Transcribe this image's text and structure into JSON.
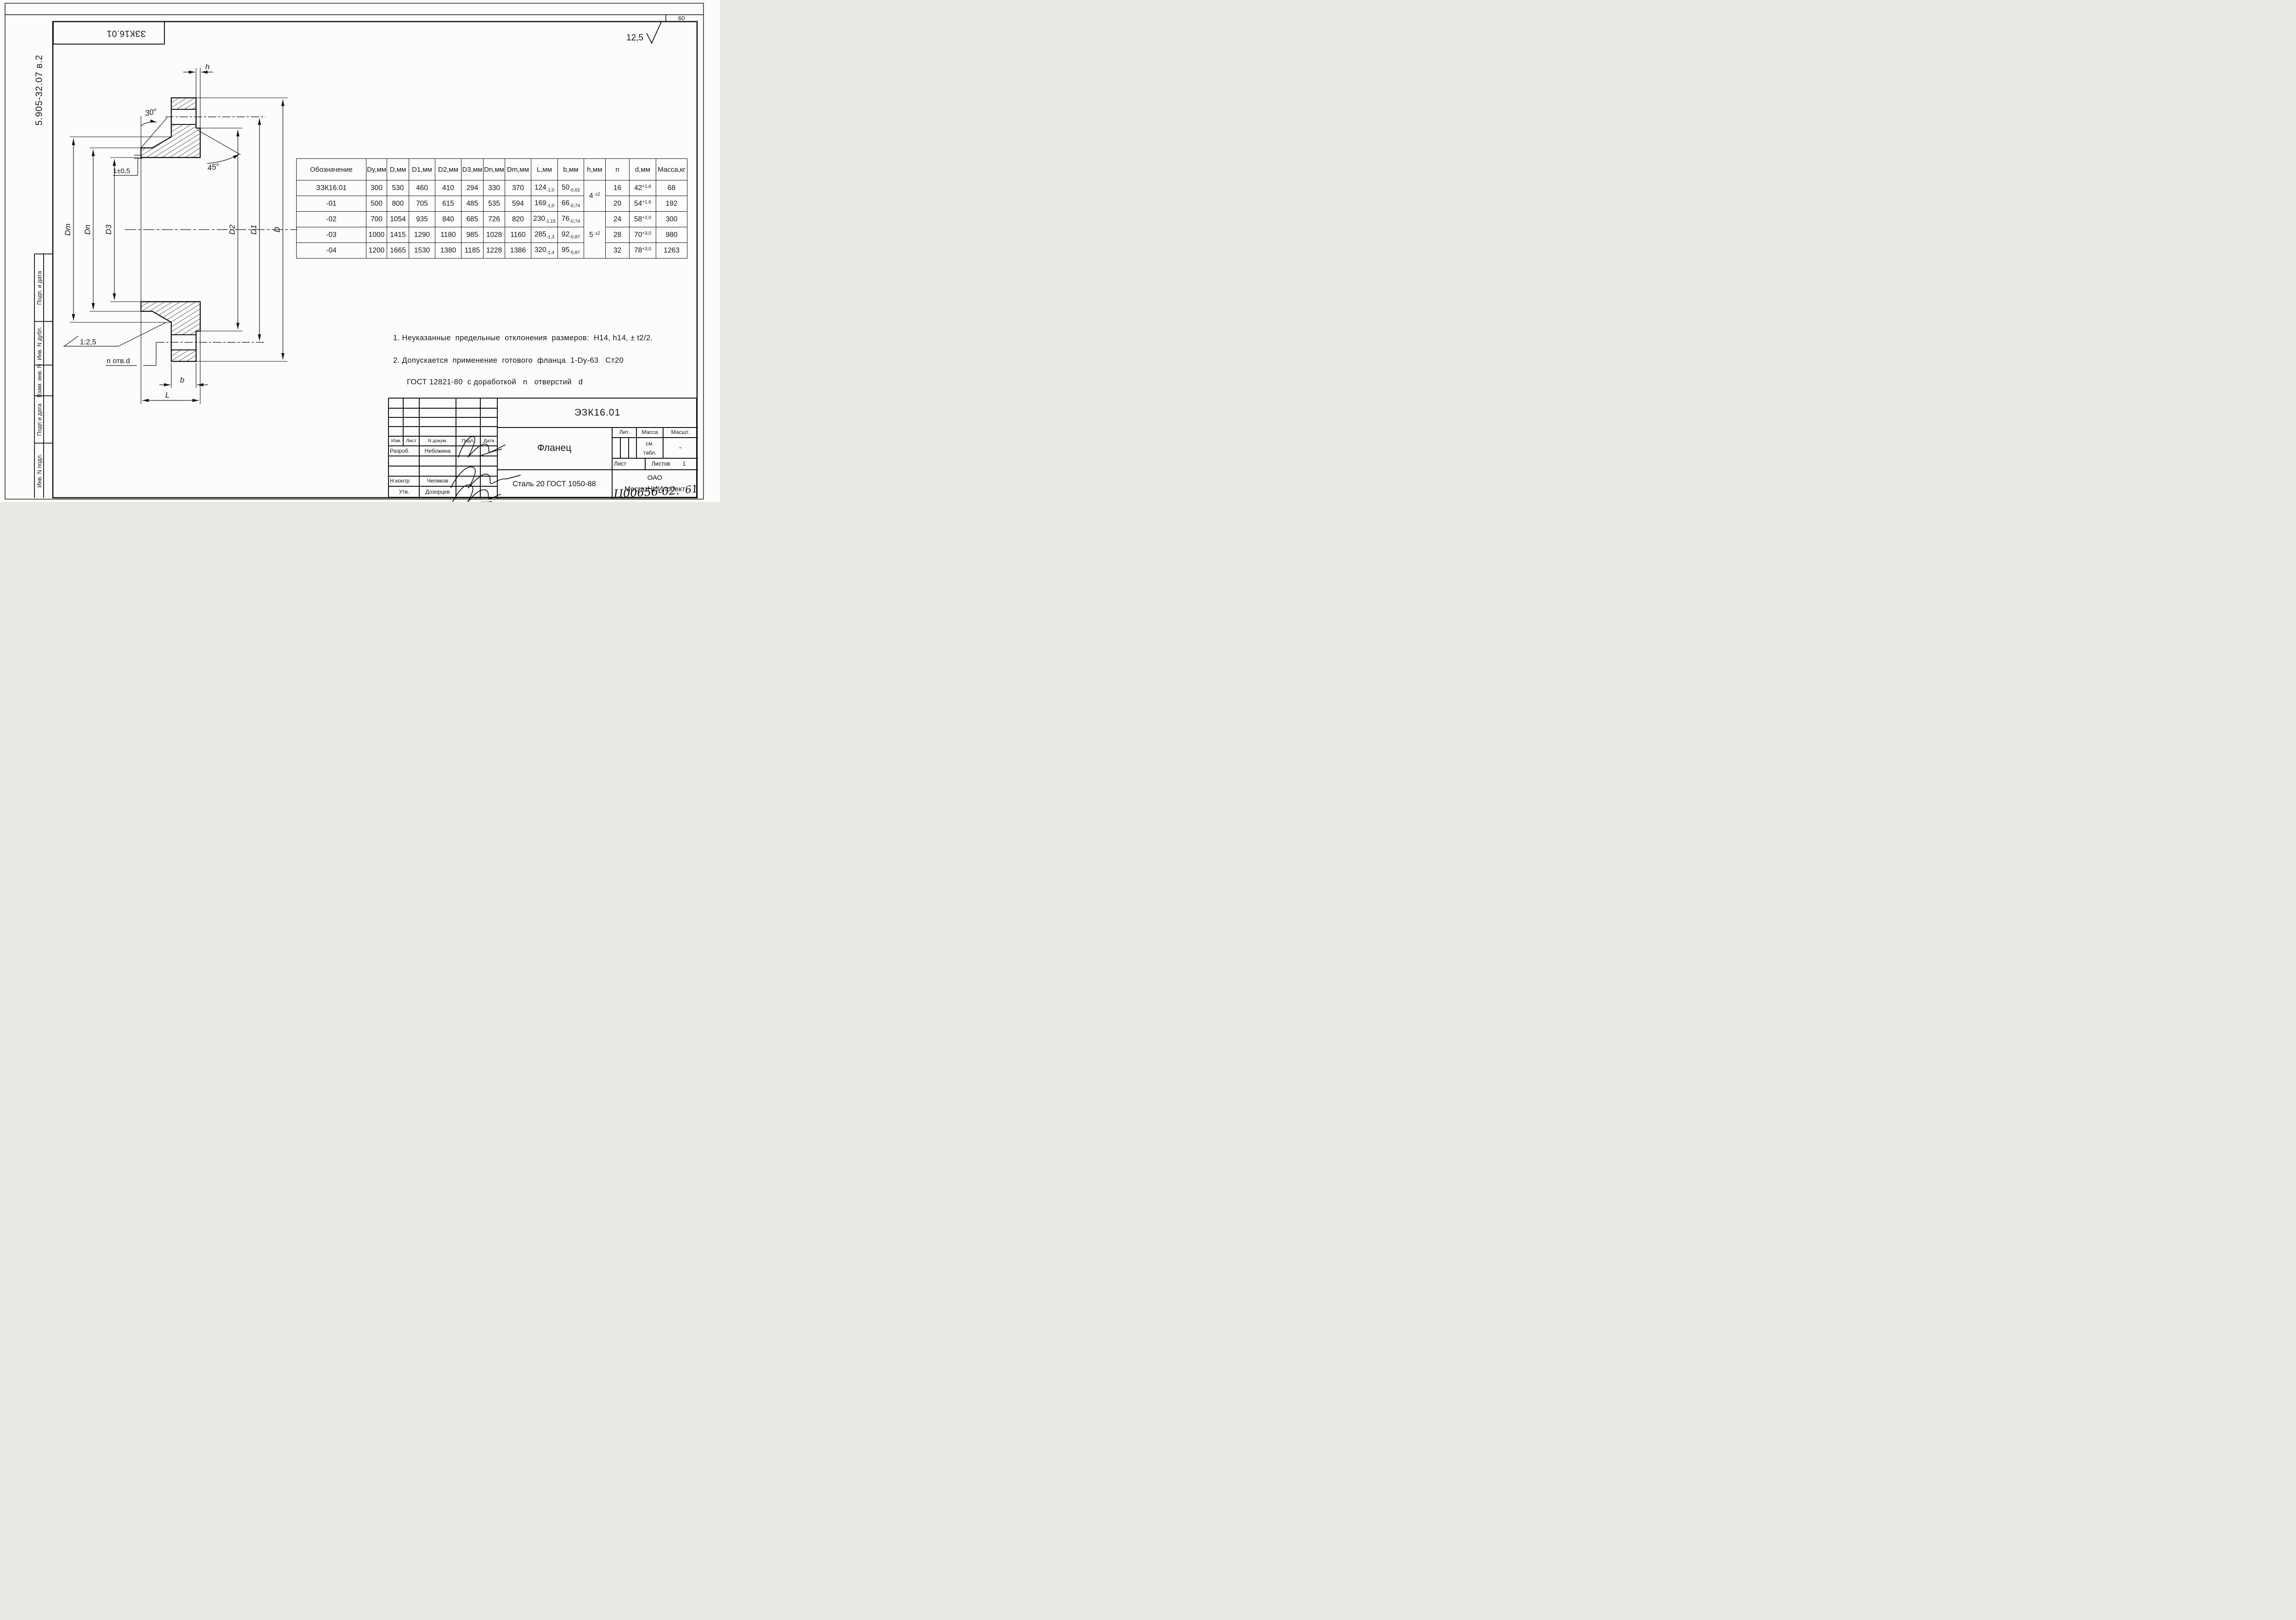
{
  "page": {
    "sheet_number": "60",
    "surface_roughness": "12,5"
  },
  "margins": {
    "doc_code_vertical": "5.905-32.07 в.2",
    "cells": [
      "Подп. и дата",
      "Инв. N дубл.",
      "Взам. инв. N",
      "Подп и дата",
      "Инв. N подл."
    ]
  },
  "top_stamp": "ЗЗК16.01",
  "drawing": {
    "labels": {
      "h": "h",
      "angle30": "30°",
      "angle45": "45°",
      "step": "1±0,5",
      "slope": "1:2,5",
      "holes": "n отв.d",
      "b": "b",
      "L": "L",
      "Dm": "Dm",
      "Dn": "Dn",
      "D3": "D3",
      "D2": "D2",
      "D1": "D1",
      "D": "D"
    }
  },
  "table": {
    "headers": [
      "Обозначение",
      "Dy,мм",
      "D,мм",
      "D1,мм",
      "D2,мм",
      "D3,мм",
      "Dn,мм",
      "Dm,мм",
      "L,мм",
      "b,мм",
      "h,мм",
      "n",
      "d,мм",
      "Масса,кг"
    ],
    "rows": [
      {
        "name": "ЗЗК16.01",
        "dy": "300",
        "d": "530",
        "d1": "460",
        "d2": "410",
        "d3": "294",
        "dn": "330",
        "dm": "370",
        "L": {
          "v": "124",
          "sub": "-1,0"
        },
        "b": {
          "v": "50",
          "sub": "-0,62"
        },
        "n": "16",
        "dhole": {
          "v": "42",
          "sup": "+1,6"
        },
        "mass": "68"
      },
      {
        "name": "-01",
        "dy": "500",
        "d": "800",
        "d1": "705",
        "d2": "615",
        "d3": "485",
        "dn": "535",
        "dm": "594",
        "L": {
          "v": "169",
          "sub": "-1,0"
        },
        "b": {
          "v": "66",
          "sub": "-0,74"
        },
        "n": "20",
        "dhole": {
          "v": "54",
          "sup": "+1,6"
        },
        "mass": "192"
      },
      {
        "name": "-02",
        "dy": "700",
        "d": "1054",
        "d1": "935",
        "d2": "840",
        "d3": "685",
        "dn": "726",
        "dm": "820",
        "L": {
          "v": "230",
          "sub": "-1,15"
        },
        "b": {
          "v": "76",
          "sub": "-0,74"
        },
        "n": "24",
        "dhole": {
          "v": "58",
          "sup": "+2,0"
        },
        "mass": "300"
      },
      {
        "name": "-03",
        "dy": "1000",
        "d": "1415",
        "d1": "1290",
        "d2": "1180",
        "d3": "985",
        "dn": "1028",
        "dm": "1160",
        "L": {
          "v": "285",
          "sub": "-1,3"
        },
        "b": {
          "v": "92",
          "sub": "-0,87"
        },
        "n": "28",
        "dhole": {
          "v": "70",
          "sup": "+3,0"
        },
        "mass": "980"
      },
      {
        "name": "-04",
        "dy": "1200",
        "d": "1665",
        "d1": "1530",
        "d2": "1380",
        "d3": "1185",
        "dn": "1228",
        "dm": "1386",
        "L": {
          "v": "320",
          "sub": "-1,4"
        },
        "b": {
          "v": "95",
          "sub": "-0,87"
        },
        "n": "32",
        "dhole": {
          "v": "78",
          "sup": "+3,0"
        },
        "mass": "1263"
      }
    ],
    "h_merged": [
      {
        "value": {
          "v": "4 ",
          "sup": "±2"
        },
        "start": 0,
        "span": 2
      },
      {
        "value": {
          "v": "5 ",
          "sup": "±2"
        },
        "start": 2,
        "span": 3
      }
    ]
  },
  "notes": [
    "1. Неуказанные  предельные  отклонения  размеров:  H14, h14, ± t2/2.",
    "2. Допускается  применение  готового  фланца  1-Dy-63   Ст20",
    "ГОСТ 12821-80  с доработкой   n   отверстий   d"
  ],
  "title_block": {
    "doc_code": "ЭЗК16.01",
    "part_name": "Фланец",
    "material": "Сталь 20 ГОСТ 1050-88",
    "company_line1": "ОАО",
    "company_line2": "МосгазНИИпроект",
    "header_cols": [
      "Изм.",
      "Лист",
      "N  докум.",
      "Подп.",
      "Дата"
    ],
    "rows": [
      {
        "role": "Разроб.",
        "name": "Небожина"
      },
      {
        "role": "Н.контр",
        "name": "Чепиков"
      },
      {
        "role": "Утв.",
        "name": "Дозорцев"
      }
    ],
    "lit_label": "Лит.",
    "mass_label": "Масса",
    "scale_label": "Масшт.",
    "mass_value_line1": "см.",
    "mass_value_line2": "табл.",
    "scale_value": "-",
    "sheet_label": "Лист",
    "sheets_label": "Листов",
    "sheets_value": "1"
  },
  "handwritten": {
    "inventory": "Ц00656-02.",
    "page": "61"
  }
}
